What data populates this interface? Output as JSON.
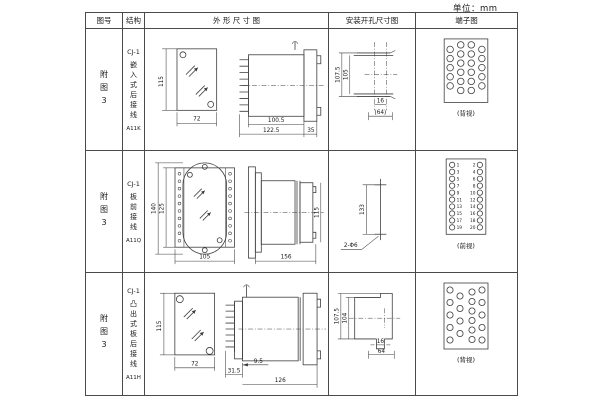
{
  "unit_label": "单位：mm",
  "headers": {
    "fig": "图号",
    "structure": "结构",
    "outline": "外 形 尺 寸 图",
    "mounting": "安装开孔尺寸图",
    "terminal": "端子图"
  },
  "rows": [
    {
      "fig_no": "附图3",
      "model": "CJ-1",
      "structure_desc": "嵌入式后接线",
      "code": "A11K",
      "outline": {
        "front_height": "115",
        "front_width": "72",
        "body_len": "100.5",
        "total_len": "122.5",
        "flange_len": "35"
      },
      "mounting": {
        "outer_v": "107.5",
        "inner_v": "105",
        "slot_w": "16",
        "span": "(64)"
      },
      "terminal": {
        "caption": "(背视)"
      }
    },
    {
      "fig_no": "附图3",
      "model": "CJ-1",
      "structure_desc": "板前接线",
      "code": "A11Q",
      "outline": {
        "outer_h": "140",
        "inner_h": "125",
        "front_width": "105",
        "body_len": "156",
        "side_h": "115"
      },
      "mounting": {
        "hole_span": "133",
        "hole_label": "2-Φ6"
      },
      "terminal": {
        "caption": "(前视)",
        "left_numbers": [
          1,
          3,
          5,
          7,
          9,
          11,
          13,
          15,
          17,
          19
        ],
        "right_numbers": [
          2,
          4,
          6,
          8,
          10,
          12,
          14,
          16,
          18,
          20
        ]
      }
    },
    {
      "fig_no": "附图3",
      "model": "CJ-1",
      "structure_desc": "凸出式板后接线",
      "code": "A11H",
      "outline": {
        "front_height": "115",
        "front_width": "72",
        "pin_len": "31.5",
        "stem_len": "9.5",
        "body_len": "126"
      },
      "mounting": {
        "outer_v": "107.5",
        "inner_v": "104",
        "slot_w": "16",
        "span": "64"
      },
      "terminal": {
        "caption": "(背视)"
      }
    }
  ]
}
